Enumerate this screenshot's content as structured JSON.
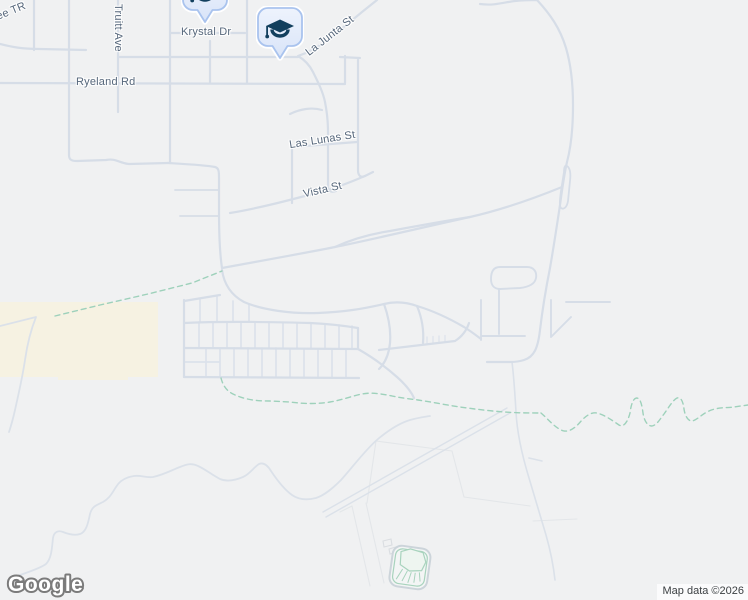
{
  "map": {
    "provider": "Google",
    "watermark": "Google",
    "attribution": "Map data ©2026",
    "colors": {
      "background": "#f0f1f2",
      "road": "#d6dde7",
      "landuse_beige": "#f6f2e2",
      "trail_dashed": "#9ed1bb",
      "street_label": "#56677b",
      "poi_pin_fill": "#e8effc",
      "poi_pin_border": "#a9c3ee",
      "poi_glyph": "#123f5e"
    },
    "street_labels": [
      {
        "text": "ree TR"
      },
      {
        "text": "Truitt Ave"
      },
      {
        "text": "Krystal Dr"
      },
      {
        "text": "La Junta St"
      },
      {
        "text": "Ryeland Rd"
      },
      {
        "text": "Las Lunas St"
      },
      {
        "text": "Vista St"
      }
    ],
    "pois": [
      {
        "category": "school",
        "icon": "graduation-cap-icon"
      },
      {
        "category": "school",
        "icon": "graduation-cap-icon"
      }
    ]
  }
}
